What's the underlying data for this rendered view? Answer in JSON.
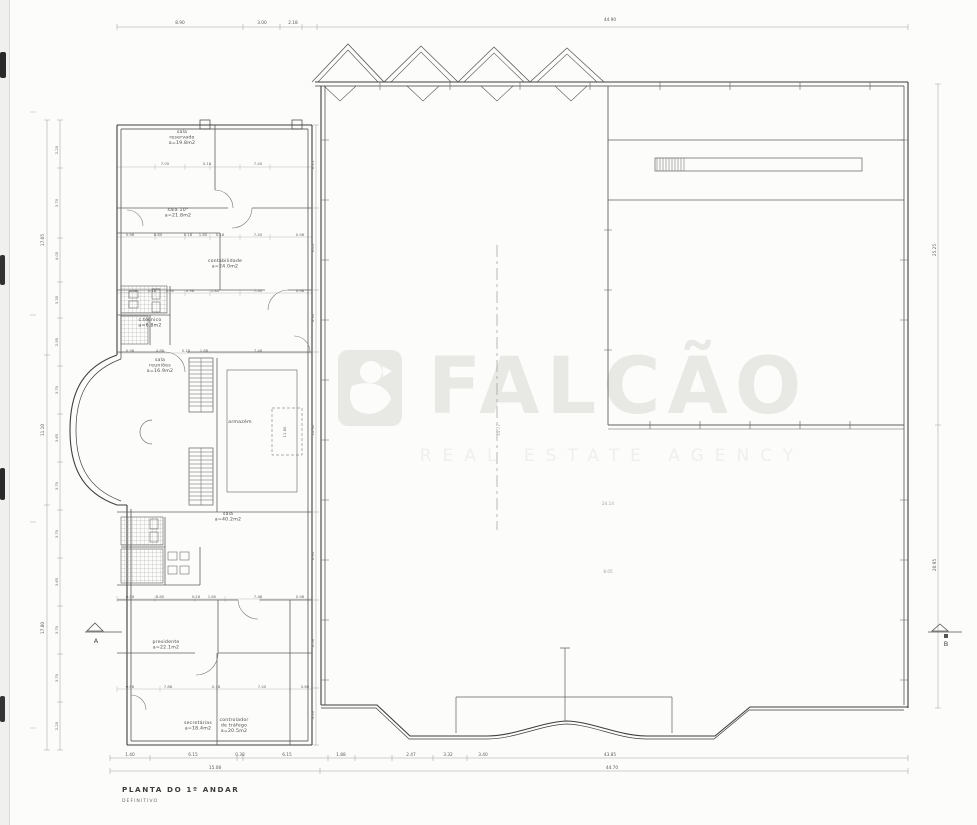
{
  "title": {
    "main": "PLANTA DO 1º ANDAR",
    "sub": "DEFINITIVO"
  },
  "watermark": {
    "brand": "FALCÃO",
    "tagline": "REAL ESTATE AGENCY",
    "logo": "falcon-logo",
    "color": "#e8e8e5"
  },
  "section_markers": {
    "a": "A",
    "b": "B"
  },
  "colors": {
    "wall": "#3e3e3e",
    "interior_wall": "#606060",
    "dimension": "#999996",
    "background": "#fcfcfa",
    "scan_mark": "#2a2a2a"
  },
  "annotations": {
    "room_labels": [
      {
        "x": 182,
        "y": 133,
        "lines": [
          "sala",
          "reservado",
          "a=19.8m2"
        ]
      },
      {
        "x": 178,
        "y": 211,
        "lines": [
          "sala 10°",
          "a=21.8m2"
        ]
      },
      {
        "x": 225,
        "y": 262,
        "lines": [
          "contabilidade",
          "a=24.0m2"
        ]
      },
      {
        "x": 150,
        "y": 321,
        "lines": [
          "c.técnico",
          "a=6.8m2"
        ]
      },
      {
        "x": 160,
        "y": 361,
        "lines": [
          "sala",
          "reuniões",
          "a=16.9m2"
        ]
      },
      {
        "x": 240,
        "y": 423,
        "lines": [
          "armazém"
        ]
      },
      {
        "x": 228,
        "y": 515,
        "lines": [
          "sala",
          "a=40.2m2"
        ]
      },
      {
        "x": 166,
        "y": 643,
        "lines": [
          "presidente",
          "a=22.1m2"
        ]
      },
      {
        "x": 198,
        "y": 724,
        "lines": [
          "secretárias",
          "a=18.4m2"
        ]
      },
      {
        "x": 234,
        "y": 721,
        "lines": [
          "controlador",
          "de tráfego",
          "a=20.5m2"
        ]
      }
    ],
    "dimension_labels": [
      {
        "x": 180,
        "y": 24,
        "t": "8.90"
      },
      {
        "x": 262,
        "y": 24,
        "t": "3.00"
      },
      {
        "x": 293,
        "y": 24,
        "t": "2.18"
      },
      {
        "x": 610,
        "y": 21,
        "t": "44.90"
      },
      {
        "x": 130,
        "y": 756,
        "t": "1.40"
      },
      {
        "x": 193,
        "y": 756,
        "t": "6.15"
      },
      {
        "x": 240,
        "y": 756,
        "t": "0.38"
      },
      {
        "x": 287,
        "y": 756,
        "t": "6.15"
      },
      {
        "x": 341,
        "y": 756,
        "t": "1.88"
      },
      {
        "x": 411,
        "y": 756,
        "t": "2.47"
      },
      {
        "x": 448,
        "y": 756,
        "t": "3.32"
      },
      {
        "x": 483,
        "y": 756,
        "t": "3.40"
      },
      {
        "x": 610,
        "y": 756,
        "t": "43.85"
      },
      {
        "x": 215,
        "y": 769,
        "t": "15.08"
      },
      {
        "x": 612,
        "y": 769,
        "t": "44.70"
      },
      {
        "x": 44,
        "y": 240,
        "t": "17.05",
        "r": -90
      },
      {
        "x": 44,
        "y": 430,
        "t": "11.10",
        "r": -90
      },
      {
        "x": 44,
        "y": 628,
        "t": "17.80",
        "r": -90
      },
      {
        "x": 58,
        "y": 150,
        "t": "2.20",
        "r": -90,
        "s": 1
      },
      {
        "x": 58,
        "y": 203,
        "t": "3.70",
        "r": -90,
        "s": 1
      },
      {
        "x": 58,
        "y": 256,
        "t": "4.05",
        "r": -90,
        "s": 1
      },
      {
        "x": 58,
        "y": 300,
        "t": "3.35",
        "r": -90,
        "s": 1
      },
      {
        "x": 58,
        "y": 342,
        "t": "2.95",
        "r": -90,
        "s": 1
      },
      {
        "x": 58,
        "y": 390,
        "t": "3.70",
        "r": -90,
        "s": 1
      },
      {
        "x": 58,
        "y": 438,
        "t": "3.65",
        "r": -90,
        "s": 1
      },
      {
        "x": 58,
        "y": 486,
        "t": "3.70",
        "r": -90,
        "s": 1
      },
      {
        "x": 58,
        "y": 534,
        "t": "3.70",
        "r": -90,
        "s": 1
      },
      {
        "x": 58,
        "y": 582,
        "t": "3.65",
        "r": -90,
        "s": 1
      },
      {
        "x": 58,
        "y": 630,
        "t": "3.70",
        "r": -90,
        "s": 1
      },
      {
        "x": 58,
        "y": 678,
        "t": "3.70",
        "r": -90,
        "s": 1
      },
      {
        "x": 58,
        "y": 726,
        "t": "2.20",
        "r": -90,
        "s": 1
      },
      {
        "x": 936,
        "y": 250,
        "t": "25.25",
        "r": -90
      },
      {
        "x": 936,
        "y": 565,
        "t": "20.95",
        "r": -90
      },
      {
        "x": 314,
        "y": 165,
        "t": "6.15",
        "r": -90,
        "s": 1
      },
      {
        "x": 314,
        "y": 248,
        "t": "6.05",
        "r": -90,
        "s": 1
      },
      {
        "x": 314,
        "y": 318,
        "t": "4.30",
        "r": -90,
        "s": 1
      },
      {
        "x": 314,
        "y": 430,
        "t": "12.40",
        "r": -90,
        "s": 1
      },
      {
        "x": 314,
        "y": 556,
        "t": "6.30",
        "r": -90,
        "s": 1
      },
      {
        "x": 314,
        "y": 643,
        "t": "6.50",
        "r": -90,
        "s": 1
      },
      {
        "x": 314,
        "y": 715,
        "t": "4.20",
        "r": -90,
        "s": 1
      },
      {
        "x": 165,
        "y": 165,
        "t": "7.05",
        "s": 1
      },
      {
        "x": 207,
        "y": 165,
        "t": "0.18",
        "s": 1
      },
      {
        "x": 258,
        "y": 165,
        "t": "7.40",
        "s": 1
      },
      {
        "x": 130,
        "y": 236,
        "t": "0.98",
        "s": 1
      },
      {
        "x": 158,
        "y": 236,
        "t": "8.80",
        "s": 1
      },
      {
        "x": 188,
        "y": 236,
        "t": "0.18",
        "s": 1
      },
      {
        "x": 203,
        "y": 236,
        "t": "1.80",
        "s": 1
      },
      {
        "x": 220,
        "y": 236,
        "t": "0.18",
        "s": 1
      },
      {
        "x": 258,
        "y": 236,
        "t": "7.40",
        "s": 1
      },
      {
        "x": 300,
        "y": 236,
        "t": "0.98",
        "s": 1
      },
      {
        "x": 133,
        "y": 292,
        "t": "1.48",
        "s": 1
      },
      {
        "x": 152,
        "y": 292,
        "t": "0.18",
        "s": 1
      },
      {
        "x": 170,
        "y": 292,
        "t": "2.30",
        "s": 1
      },
      {
        "x": 190,
        "y": 292,
        "t": "0.98",
        "s": 1
      },
      {
        "x": 215,
        "y": 292,
        "t": "1.80",
        "s": 1
      },
      {
        "x": 258,
        "y": 292,
        "t": "7.40",
        "s": 1
      },
      {
        "x": 300,
        "y": 292,
        "t": "0.98",
        "s": 1
      },
      {
        "x": 130,
        "y": 352,
        "t": "0.98",
        "s": 1
      },
      {
        "x": 160,
        "y": 352,
        "t": "4.88",
        "s": 1
      },
      {
        "x": 186,
        "y": 352,
        "t": "0.18",
        "s": 1
      },
      {
        "x": 204,
        "y": 352,
        "t": "1.88",
        "s": 1
      },
      {
        "x": 258,
        "y": 352,
        "t": "7.48",
        "s": 1
      },
      {
        "x": 130,
        "y": 598,
        "t": "0.98",
        "s": 1
      },
      {
        "x": 160,
        "y": 598,
        "t": "8.80",
        "s": 1
      },
      {
        "x": 196,
        "y": 598,
        "t": "0.18",
        "s": 1
      },
      {
        "x": 212,
        "y": 598,
        "t": "1.80",
        "s": 1
      },
      {
        "x": 258,
        "y": 598,
        "t": "7.48",
        "s": 1
      },
      {
        "x": 300,
        "y": 598,
        "t": "0.98",
        "s": 1
      },
      {
        "x": 130,
        "y": 688,
        "t": "0.98",
        "s": 1
      },
      {
        "x": 168,
        "y": 688,
        "t": "7.88",
        "s": 1
      },
      {
        "x": 216,
        "y": 688,
        "t": "0.18",
        "s": 1
      },
      {
        "x": 262,
        "y": 688,
        "t": "7.40",
        "s": 1
      },
      {
        "x": 305,
        "y": 688,
        "t": "0.80",
        "s": 1
      },
      {
        "x": 286,
        "y": 432,
        "t": "11.80",
        "r": -90,
        "s": 1
      },
      {
        "x": 500,
        "y": 430,
        "t": "14.77",
        "r": -90,
        "f": 1
      },
      {
        "x": 608,
        "y": 505,
        "t": "24.14",
        "f": 1
      },
      {
        "x": 608,
        "y": 573,
        "t": "8.05",
        "f": 1
      }
    ]
  }
}
